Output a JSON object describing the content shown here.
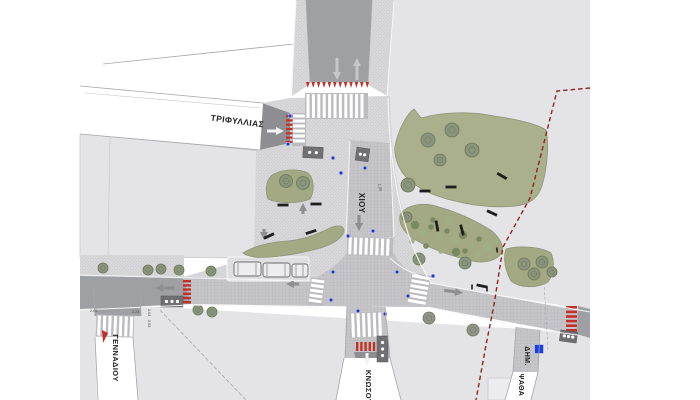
{
  "plan": {
    "type": "urban-intersection-site-plan",
    "street_labels": [
      {
        "id": "trifyllias",
        "text": "ΤΡΙΦΥΛΛΙΑΣ",
        "x": 237,
        "y": 124,
        "rot": 7.5,
        "size": 8.5
      },
      {
        "id": "chiou",
        "text": "ΧΙΟΥ",
        "x": 359,
        "y": 203,
        "rot": 90,
        "size": 8
      },
      {
        "id": "gennadiou",
        "text": "ΓΕΝΝΑΔΙΟΥ",
        "x": 113,
        "y": 358,
        "rot": 90,
        "size": 7.5
      },
      {
        "id": "knosou",
        "text": "ΚΝΩΣΟΥ",
        "x": 366,
        "y": 387,
        "rot": 90,
        "size": 7.5
      },
      {
        "id": "dim",
        "text": "ΔΗΜ.",
        "x": 525,
        "y": 356,
        "rot": 90,
        "size": 7
      },
      {
        "id": "psatha",
        "text": "ΨΑΘΑ",
        "x": 519,
        "y": 385,
        "rot": 90,
        "size": 7
      }
    ],
    "dimension_labels": [
      {
        "text": "2.00",
        "x": 90,
        "y": 312,
        "rot": 0
      },
      {
        "text": "2.23",
        "x": 132,
        "y": 313,
        "rot": 0
      },
      {
        "text": "2.02",
        "x": 148,
        "y": 309,
        "rot": 90
      },
      {
        "text": "2.53",
        "x": 148,
        "y": 320,
        "rot": 90
      },
      {
        "text": "1.20",
        "x": 378,
        "y": 184,
        "rot": 78
      }
    ],
    "colors": {
      "white": "#ffffff",
      "block": "#e4e4e6",
      "block_line": "#c9c9cc",
      "plaza": "#d8d8da",
      "plaza_dot": "#c2c2c5",
      "street": "#c6c6c9",
      "street_dot": "#b2b2b6",
      "asphalt": "#9fa0a4",
      "dark": "#8e8e92",
      "bay": "#dfdfe1",
      "curb": "#f6f6f7",
      "edge": "#a6a6aa",
      "band": "#bcbcc0",
      "stripe": "#ffffff",
      "park": "#aab08c",
      "park_edge": "#8d947a",
      "island": "#a3aa83",
      "tree": "#8b947c",
      "tree_edge": "#6c7558",
      "tree_gray": "#8f9389",
      "bush_dark": "#78875f",
      "bush_light": "#9fae83",
      "bench": "#1f1f1f",
      "red": "#c23028",
      "boundary": "#8e2321",
      "sign": "#2533c4",
      "sign_big": "#1b3fe0",
      "vehicle": "#ededef",
      "vehicle_edge": "#6a6a6e",
      "struct": "#6f6f74",
      "arrow_light": "#c7c7cb",
      "arrow_gray": "#8f8f93",
      "arrow_white": "#f2f2f2",
      "label": "#222222",
      "dim": "#444444"
    },
    "crosswalks": [
      {
        "x": 305,
        "y": 93,
        "w": 63,
        "h": 26,
        "dir": "v",
        "rot": 0
      },
      {
        "x": 292,
        "y": 113,
        "w": 14,
        "h": 33,
        "dir": "h",
        "rot": 0
      },
      {
        "x": 347,
        "y": 237,
        "w": 46,
        "h": 19,
        "dir": "v",
        "rot": 2
      },
      {
        "x": 309,
        "y": 278,
        "w": 15,
        "h": 27,
        "dir": "h",
        "rot": 8
      },
      {
        "x": 409,
        "y": 274,
        "w": 20,
        "h": 30,
        "dir": "h",
        "rot": 10
      },
      {
        "x": 96,
        "y": 315,
        "w": 38,
        "h": 22,
        "dir": "v",
        "rot": 2
      },
      {
        "x": 350,
        "y": 312,
        "w": 32,
        "h": 26,
        "dir": "v",
        "rot": -2
      }
    ],
    "red_marks": [
      {
        "type": "row-tri",
        "x": 306,
        "y": 82,
        "count": 12,
        "step": 5.4,
        "w": 3.6,
        "h": 6
      },
      {
        "type": "stack-h",
        "x": 286,
        "y": 115,
        "count": 7,
        "step": 4.3,
        "w": 6.5,
        "h": 2.2
      },
      {
        "type": "stack-h",
        "x": 183,
        "y": 280,
        "count": 6,
        "step": 4.2,
        "w": 8,
        "h": 2.4
      },
      {
        "type": "row-v",
        "x": 356,
        "y": 342,
        "count": 6,
        "step": 4.2,
        "w": 2.4,
        "h": 9
      },
      {
        "type": "stack-h",
        "x": 566,
        "y": 306,
        "count": 6,
        "step": 4.6,
        "w": 11,
        "h": 2.6
      },
      {
        "type": "tri",
        "pts": "102,330 108,333 103,343"
      }
    ],
    "arrows": [
      {
        "x": 337,
        "y": 80,
        "dir": "down",
        "len": 22,
        "c": "light"
      },
      {
        "x": 357,
        "y": 58,
        "dir": "up",
        "len": 22,
        "c": "light"
      },
      {
        "x": 284,
        "y": 131,
        "dir": "right",
        "len": 17,
        "c": "white"
      },
      {
        "x": 359,
        "y": 231,
        "dir": "down",
        "len": 16,
        "c": "gray"
      },
      {
        "x": 155,
        "y": 288,
        "dir": "left",
        "len": 20,
        "c": "gray"
      },
      {
        "x": 286,
        "y": 284,
        "dir": "left",
        "len": 13,
        "c": "gray"
      },
      {
        "x": 463,
        "y": 293,
        "dir": "right",
        "len": 19,
        "c": "gray",
        "rot": 8
      },
      {
        "x": 367,
        "y": 366,
        "dir": "down",
        "len": 13,
        "c": "white"
      },
      {
        "x": 303,
        "y": 203,
        "dir": "up",
        "len": 11,
        "c": "gray"
      },
      {
        "x": 264,
        "y": 240,
        "dir": "down",
        "len": 11,
        "c": "gray"
      }
    ],
    "vehicles": [
      {
        "x": 234,
        "y": 262,
        "w": 27,
        "h": 14
      },
      {
        "x": 263,
        "y": 263,
        "w": 27,
        "h": 14
      },
      {
        "x": 292,
        "y": 264,
        "w": 16,
        "h": 13
      }
    ],
    "structures": [
      {
        "x": 303,
        "y": 147,
        "w": 20,
        "h": 11,
        "r": 3,
        "d": 2
      },
      {
        "x": 356,
        "y": 148,
        "w": 13,
        "h": 13,
        "r": 8,
        "d": 2
      },
      {
        "x": 161,
        "y": 296,
        "w": 22,
        "h": 11,
        "r": 0,
        "d": 3
      },
      {
        "x": 377,
        "y": 336,
        "w": 11,
        "h": 26,
        "r": 0,
        "d": 3
      },
      {
        "x": 560,
        "y": 331,
        "w": 17,
        "h": 11,
        "r": 8,
        "d": 3
      }
    ],
    "trees": [
      {
        "x": 103,
        "y": 268,
        "r": 5
      },
      {
        "x": 148,
        "y": 270,
        "r": 5
      },
      {
        "x": 161,
        "y": 269,
        "r": 5
      },
      {
        "x": 179,
        "y": 270,
        "r": 5
      },
      {
        "x": 211,
        "y": 271,
        "r": 5
      },
      {
        "x": 198,
        "y": 310,
        "r": 5
      },
      {
        "x": 212,
        "y": 312,
        "r": 5
      },
      {
        "x": 286,
        "y": 181,
        "r": 6.5
      },
      {
        "x": 303,
        "y": 183,
        "r": 6.5
      },
      {
        "x": 428,
        "y": 140,
        "r": 7
      },
      {
        "x": 452,
        "y": 130,
        "r": 7
      },
      {
        "x": 472,
        "y": 150,
        "r": 7
      },
      {
        "x": 440,
        "y": 160,
        "r": 6
      },
      {
        "x": 408,
        "y": 185,
        "r": 7
      },
      {
        "x": 407,
        "y": 217,
        "r": 5
      },
      {
        "x": 419,
        "y": 259,
        "r": 6
      },
      {
        "x": 465,
        "y": 263,
        "r": 6
      },
      {
        "x": 524,
        "y": 264,
        "r": 6
      },
      {
        "x": 534,
        "y": 274,
        "r": 6
      },
      {
        "x": 542,
        "y": 262,
        "r": 6
      },
      {
        "x": 552,
        "y": 272,
        "r": 5
      },
      {
        "x": 429,
        "y": 318,
        "r": 6,
        "t": "gray"
      },
      {
        "x": 473,
        "y": 330,
        "r": 6,
        "t": "gray"
      }
    ],
    "bushes": [
      {
        "x": 415,
        "y": 225
      },
      {
        "x": 423,
        "y": 233
      },
      {
        "x": 431,
        "y": 227
      },
      {
        "x": 439,
        "y": 237
      },
      {
        "x": 447,
        "y": 231
      },
      {
        "x": 455,
        "y": 241
      },
      {
        "x": 463,
        "y": 235
      },
      {
        "x": 471,
        "y": 245
      },
      {
        "x": 479,
        "y": 239
      },
      {
        "x": 487,
        "y": 247
      },
      {
        "x": 426,
        "y": 246
      },
      {
        "x": 441,
        "y": 251
      },
      {
        "x": 456,
        "y": 252
      },
      {
        "x": 412,
        "y": 241
      },
      {
        "x": 433,
        "y": 220
      },
      {
        "x": 449,
        "y": 221
      },
      {
        "x": 465,
        "y": 251
      },
      {
        "x": 478,
        "y": 254
      }
    ],
    "benches": [
      {
        "x": 425,
        "y": 191,
        "r": 0
      },
      {
        "x": 451,
        "y": 187,
        "r": 0
      },
      {
        "x": 492,
        "y": 213,
        "r": 25
      },
      {
        "x": 437,
        "y": 226,
        "r": 80
      },
      {
        "x": 283,
        "y": 205,
        "r": 0
      },
      {
        "x": 316,
        "y": 204,
        "r": 0
      },
      {
        "x": 269,
        "y": 236,
        "r": -25
      },
      {
        "x": 311,
        "y": 232,
        "r": -18
      },
      {
        "x": 502,
        "y": 176,
        "r": 30
      },
      {
        "x": 462,
        "y": 230,
        "r": 75
      },
      {
        "x": 482,
        "y": 286,
        "r": 12
      },
      {
        "x": 472,
        "y": 287,
        "r": 90,
        "s": 1
      },
      {
        "x": 487,
        "y": 289,
        "r": 90,
        "s": 1
      },
      {
        "x": 497,
        "y": 250,
        "r": 80,
        "s": 1
      }
    ],
    "signs": [
      {
        "x": 290,
        "y": 116
      },
      {
        "x": 288,
        "y": 144
      },
      {
        "x": 333,
        "y": 158
      },
      {
        "x": 365,
        "y": 168
      },
      {
        "x": 341,
        "y": 173
      },
      {
        "x": 348,
        "y": 236
      },
      {
        "x": 373,
        "y": 231
      },
      {
        "x": 333,
        "y": 272
      },
      {
        "x": 397,
        "y": 272
      },
      {
        "x": 433,
        "y": 276
      },
      {
        "x": 408,
        "y": 296
      },
      {
        "x": 331,
        "y": 300
      },
      {
        "x": 358,
        "y": 311
      },
      {
        "x": 385,
        "y": 314
      },
      {
        "x": 539,
        "y": 349,
        "big": true
      }
    ],
    "boundary_line": "590,88 557,91 530,198 503,247 494,305 486,345 476,400"
  }
}
